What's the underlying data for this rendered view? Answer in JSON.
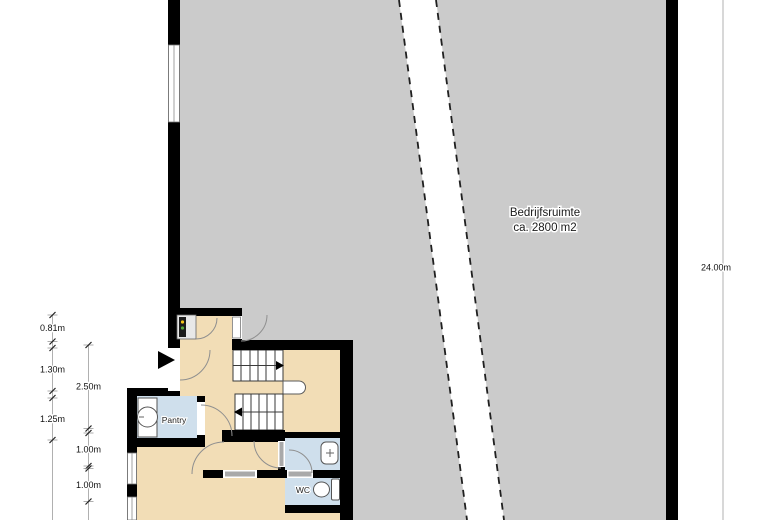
{
  "hall": {
    "label_line1": "Bedrijfsruimte",
    "label_line2": "ca. 2800 m2"
  },
  "rooms": {
    "pantry": "Pantry",
    "wc": "WC"
  },
  "dims": {
    "right": "24.00m",
    "col1": [
      "0.81m",
      "1.30m",
      "1.25m"
    ],
    "col2": [
      "2.50m",
      "1.00m",
      "1.00m"
    ]
  },
  "colors": {
    "hall_floor": "#cbcbcb",
    "interior_floor": "#f2ddb6",
    "wet_room": "#cfdfec",
    "wall": "#000000",
    "fixture_outline": "#555555",
    "dimension_line": "#b0b0b0",
    "text": "#111111"
  }
}
